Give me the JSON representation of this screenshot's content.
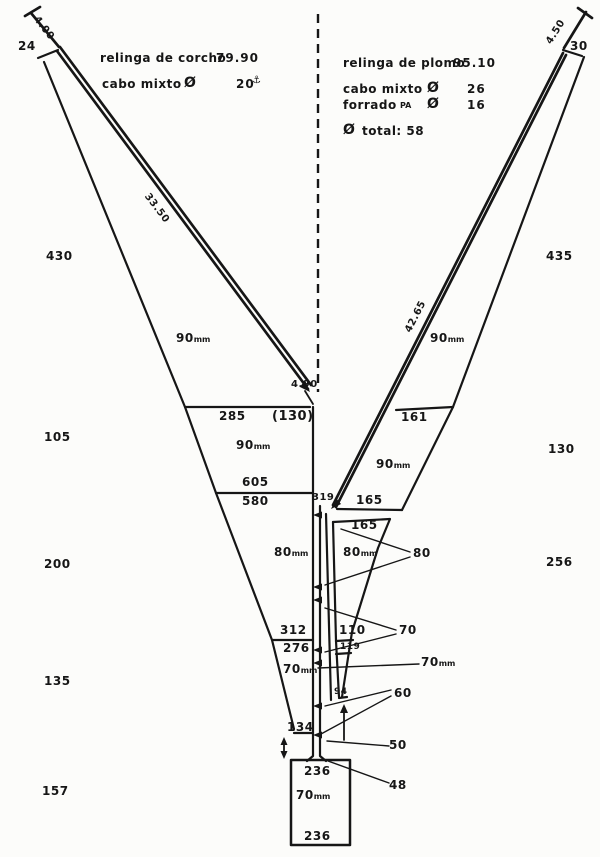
{
  "notes_left": {
    "relinga_label": "relinga de corcho",
    "relinga_value": "79.90",
    "cabo_label": "cabo mixto",
    "dia_symbol": "Ø",
    "cabo_value": "20",
    "hook_icon": "⚓"
  },
  "notes_right": {
    "relinga_label": "relinga de plomo",
    "relinga_value": "95.10",
    "cabo_label": "cabo mixto",
    "dia_symbol": "Ø",
    "cabo_value": "26",
    "forrado_label": "forrado",
    "forrado_material": "PA",
    "forrado_value": "16",
    "total_label": "total: 58"
  },
  "ropes": {
    "left_bridle": "4.00",
    "left_headrope": "33.50",
    "left_headrope_end": "4.90",
    "right_bridle": "4.50",
    "right_footrope": "42.65"
  },
  "counts": {
    "left": [
      "24",
      "430",
      "105",
      "200",
      "135",
      "157"
    ],
    "right": [
      "30",
      "435",
      "130",
      "256"
    ]
  },
  "panels": {
    "left_wing_mesh": "90",
    "right_wing_mesh_upper": "90",
    "right_wing_mesh_lower": "90",
    "square_top": "285",
    "square_depth": "(130)",
    "square_mesh": "90",
    "square_bottom": "605",
    "belly1_top": "580",
    "belly1_mesh": "80",
    "belly1_bottom": "312",
    "belly2_top": "276",
    "belly2_mesh": "70",
    "belly2_bottom": "134",
    "right_wing_cross": "161",
    "right_wing_bottom": "165",
    "rbelly_top": "165",
    "rbelly_mesh": "80",
    "rbelly_cross1": "110",
    "rbelly_cross2": "119",
    "rbelly_bottom": "94",
    "selvedge_top": "319",
    "codend_top": "236",
    "codend_mesh": "70",
    "codend_bottom": "236"
  },
  "leaders": {
    "l80": "80",
    "l70": "70",
    "l70mm": "70",
    "l60": "60",
    "l50": "50",
    "l48": "48"
  },
  "unit_mm": "mm"
}
